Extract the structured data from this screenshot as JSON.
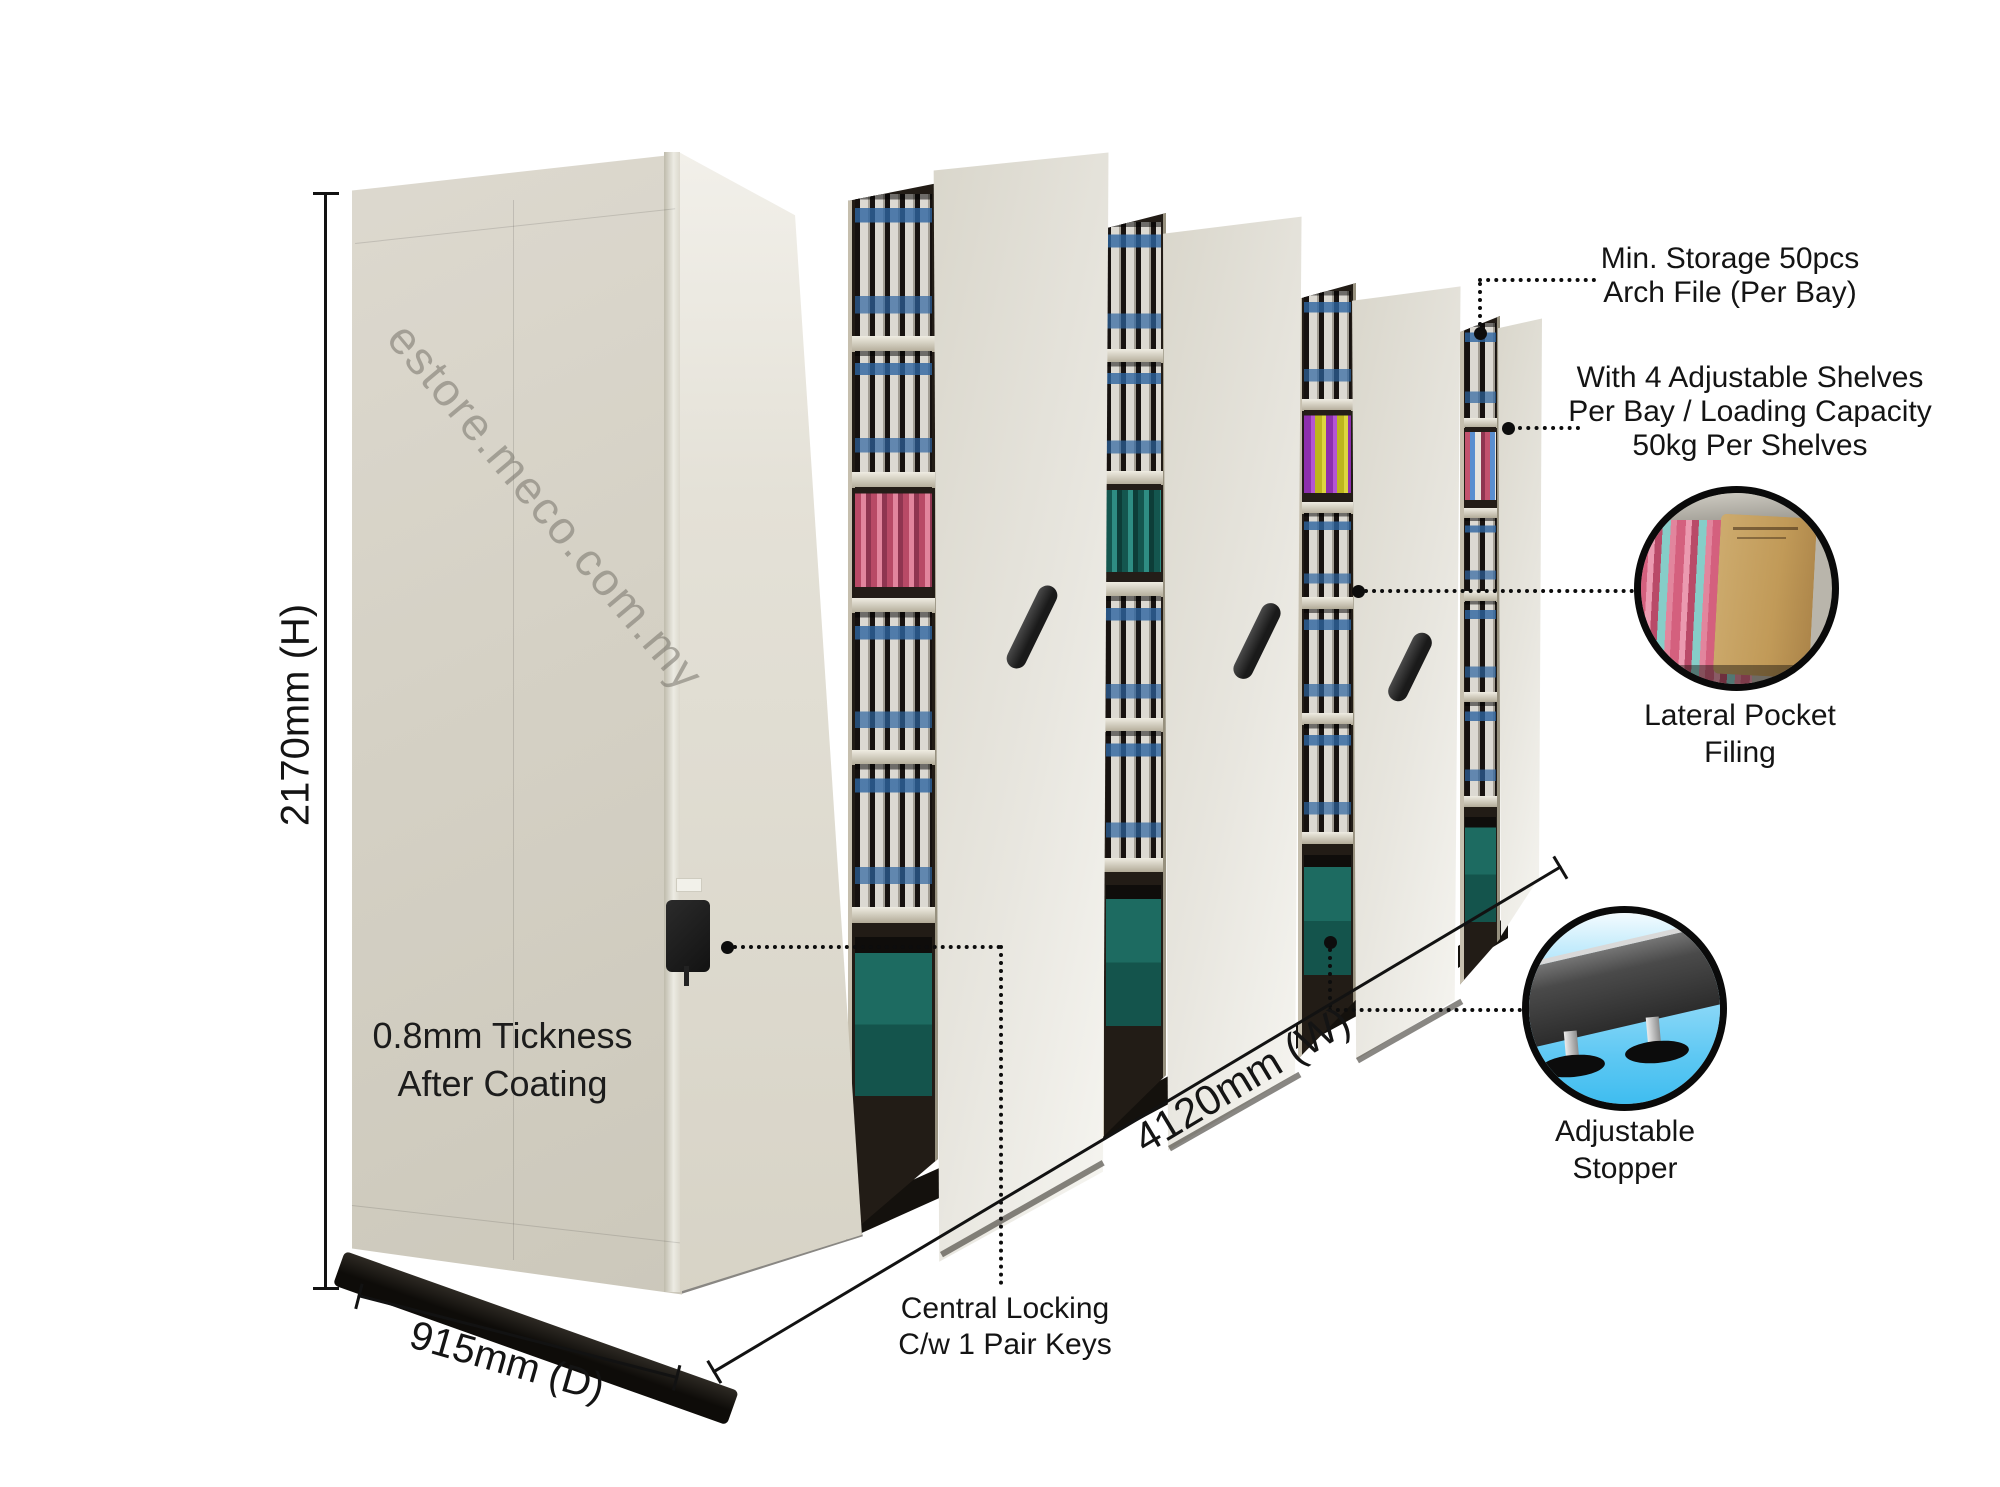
{
  "watermark": "estore.meco.com.my",
  "dimensions": {
    "height": "2170mm (H)",
    "depth": "915mm (D)",
    "width": "4120mm (W)"
  },
  "callouts": {
    "thickness_line1": "0.8mm Tickness",
    "thickness_line2": "After Coating",
    "min_storage_line1": "Min. Storage 50pcs",
    "min_storage_line2": "Arch File (Per Bay)",
    "shelves_line1": "With 4 Adjustable Shelves",
    "shelves_line2": "Per Bay / Loading Capacity",
    "shelves_line3": "50kg Per Shelves",
    "lateral_line1": "Lateral Pocket",
    "lateral_line2": "Filing",
    "locking_line1": "Central Locking",
    "locking_line2": "C/w 1 Pair Keys",
    "stopper_line1": "Adjustable",
    "stopper_line2": "Stopper"
  },
  "colors": {
    "cabinet_beige": "#d6d2c6",
    "panel_light": "#e8e6df",
    "rail_black": "#14110d",
    "annotation_text": "#141414",
    "binder_label_blue": "#2d64a0",
    "hanging_pink": "#d4607e",
    "hanging_teal": "#2e8d83",
    "hanging_purple": "#8d2fae",
    "hanging_yellow": "#ddd63f",
    "box_teal": "#1d6b61",
    "stopper_sky_blue": "#5ec8f3",
    "kraft_tan": "#c9a86a"
  }
}
